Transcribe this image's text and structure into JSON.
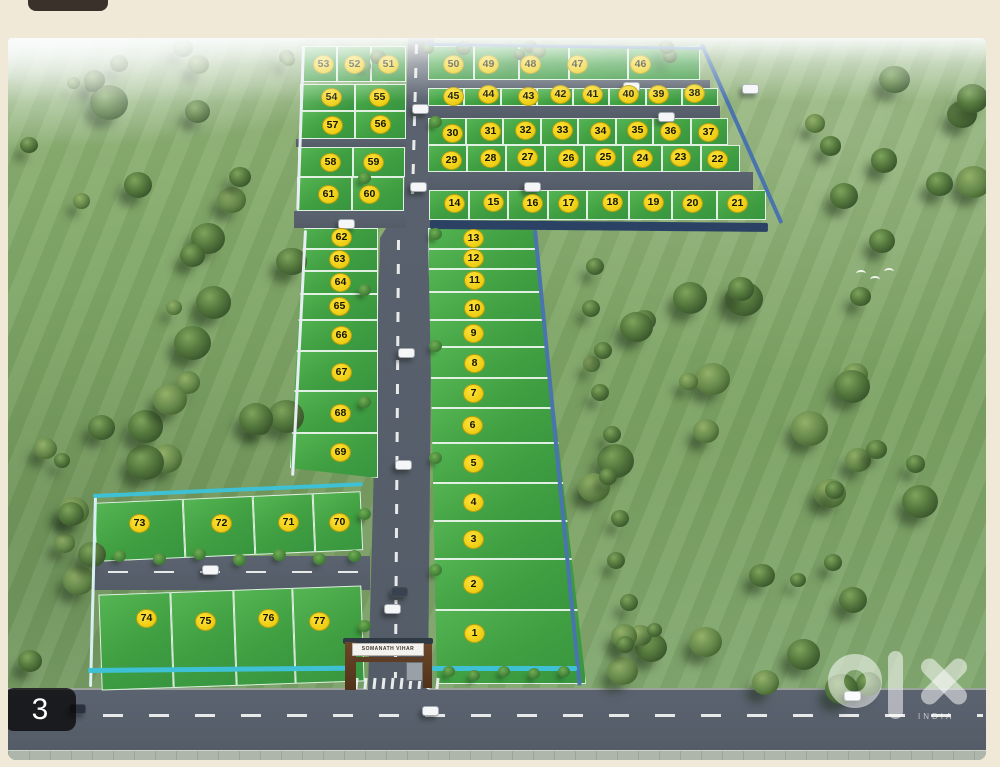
{
  "photo": {
    "counter": "3",
    "watermark_brand": "olx",
    "watermark_country": "INDIA"
  },
  "estate": {
    "gate_sign": "SOMANATH VIHAR",
    "blocks": {
      "left_top_rows": [
        [
          "53",
          "52",
          "51"
        ],
        [
          "54",
          "55"
        ],
        [
          "57",
          "56"
        ],
        [
          "58",
          "59"
        ],
        [
          "61",
          "60"
        ]
      ],
      "right_top_rows": [
        [
          "50",
          "49",
          "48",
          "47",
          "46"
        ],
        [
          "45",
          "44",
          "43",
          "42",
          "41",
          "40",
          "39",
          "38"
        ],
        [
          "30",
          "31",
          "32",
          "33",
          "34",
          "35",
          "36",
          "37"
        ],
        [
          "29",
          "28",
          "27",
          "26",
          "25",
          "24",
          "23",
          "22"
        ],
        [
          "14",
          "15",
          "16",
          "17",
          "18",
          "19",
          "20",
          "21"
        ]
      ],
      "left_column": [
        "62",
        "63",
        "64",
        "65",
        "66",
        "67",
        "68",
        "69"
      ],
      "center_column": [
        "13",
        "12",
        "11",
        "10",
        "9",
        "8",
        "7",
        "6",
        "5",
        "4",
        "3",
        "2",
        "1"
      ],
      "bottom_left_rows": [
        [
          "73",
          "72",
          "71",
          "70"
        ],
        [
          "74",
          "75",
          "76",
          "77"
        ]
      ]
    },
    "colors": {
      "plot_green": "#41a746",
      "badge_yellow": "#f4d416",
      "badge_text": "#151400",
      "wall_blue": "#4a74ae",
      "wall_teal": "#3ec1d5",
      "road_gray": "#565e6a",
      "grass_green": "#81a768",
      "page_cream": "#f0e9d7"
    }
  }
}
